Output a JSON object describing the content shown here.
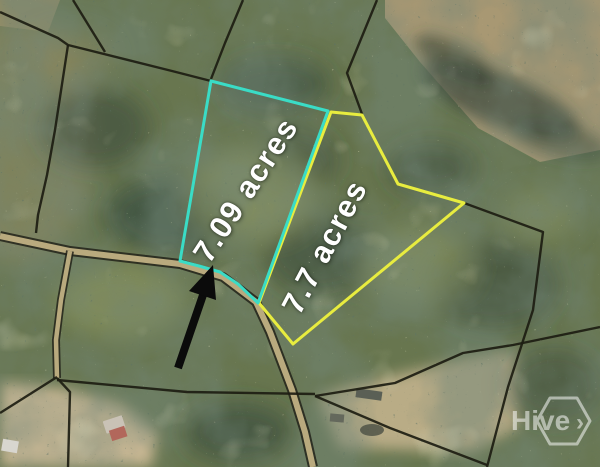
{
  "parcels": [
    {
      "id": "parcel-a",
      "label": "7.09 acres",
      "outline_color": "#3ADCC6",
      "points": "211,81 328,111 258,303 238,284 220,272 199,266 180,261"
    },
    {
      "id": "parcel-b",
      "label": "7.7 acres",
      "outline_color": "#E8EC3F",
      "points": "331,112 362,115 398,184 464,203 293,344 259,303"
    }
  ],
  "boundaries": [
    "0,12 58,38 68,45 172,71 211,81",
    "73,0 105,52",
    "243,0 225,43 211,79",
    "377,0 347,73 362,114",
    "464,203 543,232 533,310 508,387 487,467",
    "315,396 395,383 463,353 513,345 600,327",
    "315,396 390,428 487,465",
    "57,380 187,392 315,394",
    "57,377 0,413",
    "57,378 70,392 68,467",
    "68,45 55,130 47,175 38,215 36,233"
  ],
  "roads": [
    "M0,236 L70,251 L180,264 L223,277 L256,302 L270,332 L292,390 L305,432 L313,467",
    "M70,251 L61,300 L56,340 L57,378"
  ],
  "arrow": {
    "shaft": "M178,368 L203,295",
    "head": "213,265 216,300 189,291"
  },
  "watermark": {
    "text": "Hive",
    "chevron": "›"
  },
  "colors": {
    "parcel_a_outline": "#3ADCC6",
    "parcel_b_outline": "#E8EC3F",
    "boundary_line": "#1D1D12",
    "road_fill": "#B9AA7E",
    "acre_label_text": "#FFFFFF",
    "arrow": "#0B0B0B",
    "watermark": "#FFFFFF"
  }
}
